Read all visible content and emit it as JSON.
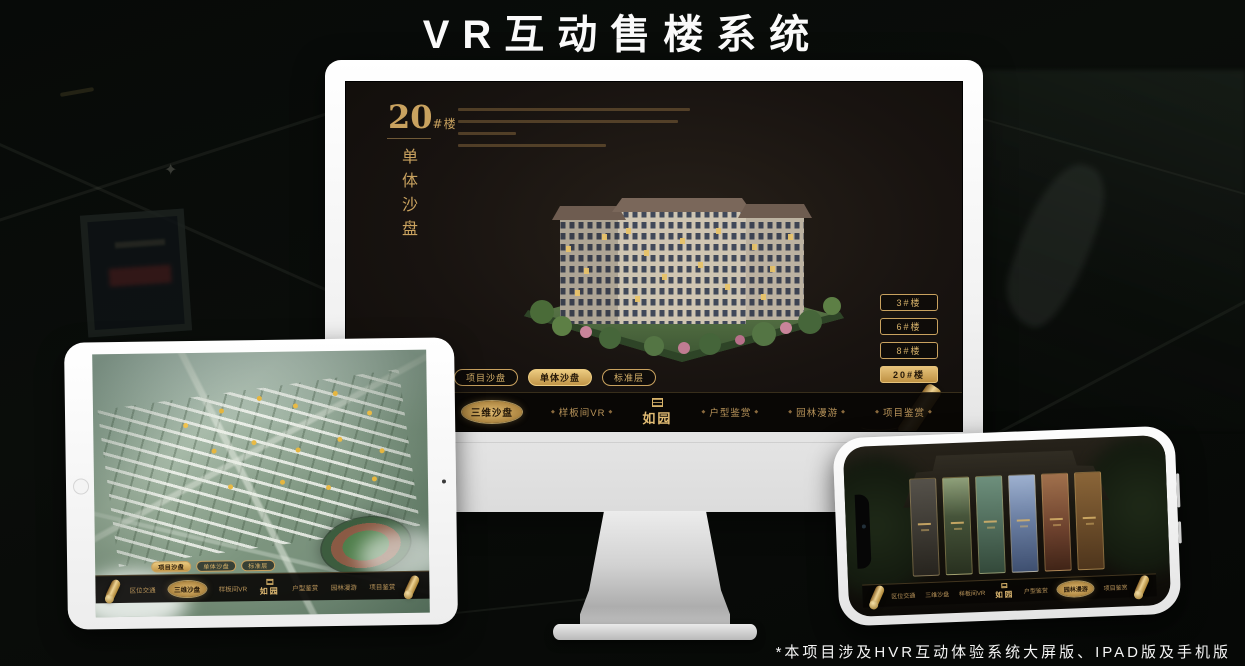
{
  "page": {
    "title": "VR互动售楼系统",
    "footnote": "*本项目涉及HVR互动体验系统大屏版、IPAD版及手机版"
  },
  "colors": {
    "gold": "#c9a25f",
    "gold_bright": "#e2bc74",
    "selected_fill": "#c19548",
    "screen_bg": "#18130e",
    "nav_bg": "#0b0805"
  },
  "app": {
    "logo": {
      "text": "如园",
      "seal_icon": "seal-icon"
    },
    "heading": {
      "number": "20",
      "suffix": "#楼",
      "subtitle_vertical": "单体沙盘"
    },
    "tabs": [
      {
        "label": "项目沙盘"
      },
      {
        "label": "单体沙盘"
      },
      {
        "label": "标准层"
      }
    ],
    "monitor_selected_tab": "单体沙盘",
    "ipad_selected_tab": "项目沙盘",
    "nav_items": [
      {
        "label": "区位交通"
      },
      {
        "label": "三维沙盘"
      },
      {
        "label": "样板间VR"
      },
      {
        "label": "户型鉴赏"
      },
      {
        "label": "园林漫游"
      },
      {
        "label": "项目鉴赏"
      }
    ],
    "monitor_selected_nav": "三维沙盘",
    "ipad_selected_nav": "三维沙盘",
    "phone_selected_nav": "园林漫游",
    "floor_buttons": [
      {
        "label": "3#楼",
        "selected": false
      },
      {
        "label": "6#楼",
        "selected": false
      },
      {
        "label": "8#楼",
        "selected": false
      },
      {
        "label": "20#楼",
        "selected": true
      }
    ],
    "scroll_icon": "gold-scroll-icon"
  },
  "devices": {
    "monitor": "大屏版",
    "tablet": "IPAD版",
    "phone": "手机版"
  }
}
